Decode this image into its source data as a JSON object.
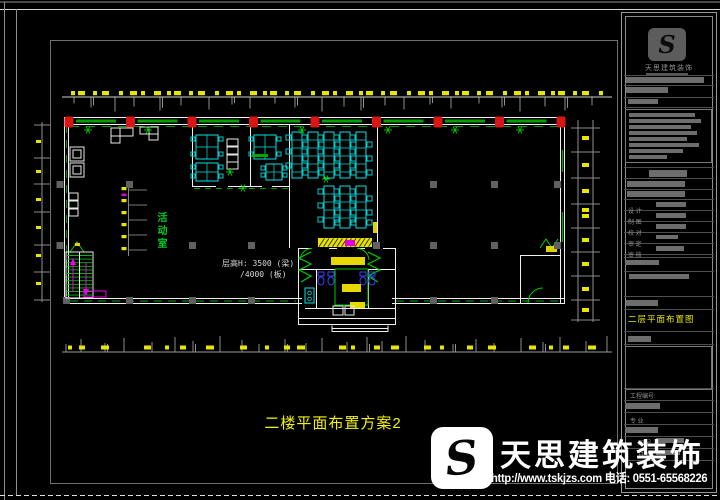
{
  "drawing": {
    "main_title": "二楼平面布置方案2",
    "room_label": "活动室",
    "floor_note_line1": "层高H: 3500 (梁)",
    "floor_note_line2": "/4000 (板)"
  },
  "title_block": {
    "logo_letter": "S",
    "company_name": "天思建筑装饰",
    "drawing_name": "二层平面布置图",
    "labels": {
      "design": "设 计",
      "draft": "制 图",
      "check": "校 对",
      "approve": "审 定",
      "review": "审 核",
      "project_no": "工程编号:",
      "specialty": "专 业",
      "drawing_no": "图 号",
      "date": "日 期"
    }
  },
  "watermark": {
    "logo_letter": "S",
    "brand": "天思建筑装饰",
    "contact": "http://www.tskjzs.com 电话: 0551-65568226"
  },
  "colors": {
    "wall": "#f0f0f0",
    "window": "#00aa00",
    "furniture": "#00e5e5",
    "dimension_label": "#e6e600",
    "column": "#d81616",
    "title": "#f2f20a"
  }
}
